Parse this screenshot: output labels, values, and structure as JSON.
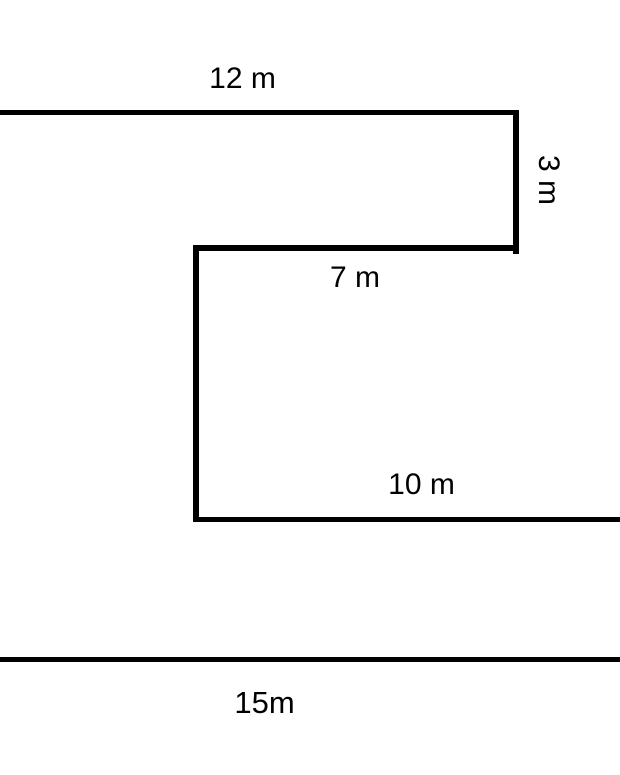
{
  "diagram": {
    "type": "composite-shape-geometry-figure",
    "background_color": "#ffffff",
    "stroke_color": "#000000",
    "labels": {
      "side_12m": "12 m",
      "side_3m": "3 m",
      "side_7m": "7 m",
      "side_10m": "10 m",
      "side_15m": "15m"
    }
  }
}
